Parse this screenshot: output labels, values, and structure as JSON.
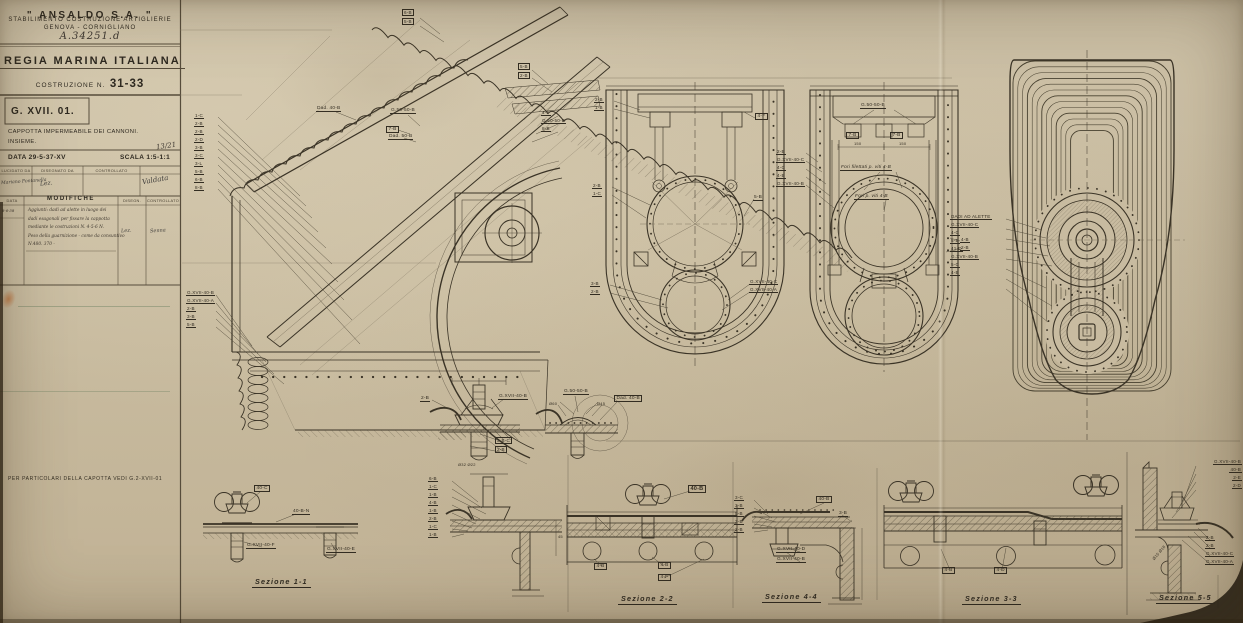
{
  "colors": {
    "paper": "#c8bba0",
    "ink": "#3a3326"
  },
  "title_block": {
    "company": "\" ANSALDO  S.A. \"",
    "establishment": "STABILIMENTO COSTRUZIONE ARTIGLIERIE",
    "location": "GENOVA - CORNIGLIANO",
    "file_number": "A.34251.d",
    "org": "REGIA MARINA ITALIANA",
    "costruzione_label": "COSTRUZIONE N.",
    "costruzione_number": "31-33",
    "drawing_code": "G. XVII. 01.",
    "subject_line1": "CAPPOTTA IMPERMEABILE DEI CANNONI.",
    "subject_line2": "INSIEME.",
    "date": "DATA 29-5-37-XV",
    "scale": "SCALA 1:5-1:1",
    "sheet_mark": "13/21",
    "sig_headers": [
      "LUCIDATO DA",
      "DISEGNATO DA",
      "CONTROLLATO"
    ],
    "signatures": [
      "Mariano Fontanella",
      "Lez.",
      "Valdata"
    ],
    "mod_headers": [
      "DATA",
      "MODIFICHE",
      "DISEGN.",
      "CONTROLLATO"
    ],
    "mod_date": "8-6-38",
    "mod_lines": [
      "Aggiunti: dadi ad alette in luogo dei",
      "dadi esagonali per fissare la cappotta",
      "mediante le costruzioni N. 4-5-6 N.",
      "Peso della guarnizione - come da consuntivo",
      "N.480. 370 -"
    ],
    "mod_sig_disegn": "Lez.",
    "mod_sig_contr": "Senna"
  },
  "notes": {
    "details_note": "PER PARTICOLARI DELLA CAPOTTA VEDI G.2-XVII-01"
  },
  "sections": {
    "s1": "Sezione 1-1",
    "s2": "Sezione 2-2",
    "s3": "Sezione 3-3",
    "s4": "Sezione 4-4",
    "s5": "Sezione 5-5"
  },
  "main_view": {
    "left_stack": [
      "1-C",
      "2-B",
      "2-B",
      "2-D",
      "3-B",
      "3-C",
      "3-L",
      "5-B",
      "6-B",
      "8-B"
    ],
    "left_stack2": [
      "G.XVII-40-B",
      "G.XVII-40-A",
      "2-B",
      "3-B",
      "5-B"
    ],
    "top_stack": [
      "6-B",
      "5-B"
    ],
    "mid_stack": [
      "5-B",
      "2-B"
    ],
    "breech_labels": [
      "Dad. 40-B",
      "G.50-50-B",
      "7-B",
      "Dad. 50-B"
    ],
    "right_stack": [
      "4-F",
      "G.50-50-B",
      "8-B"
    ]
  },
  "plan_view_1": {
    "left_top": [
      "2-B",
      "1-B"
    ],
    "left_mid": [
      "2-B",
      "1-C"
    ],
    "left_bottom": [
      "3-B",
      "2-B"
    ],
    "right_top": "4-F",
    "right_mid": "5-B",
    "right_bottom": [
      "G.XVII-40-C",
      "G.XVII-40-A"
    ]
  },
  "plan_view_2": {
    "top_label": "G.50-50-B",
    "fittings": [
      "7-B",
      "7-B"
    ],
    "dims": [
      "150",
      "150"
    ],
    "note_threads": "Fori filettati p. viti 4-B",
    "note_holes": "Fori p. viti 4-B",
    "left_stack": [
      "2-B",
      "G.XVII-40-C",
      "4-C",
      "4-B",
      "G.XVII-40-B"
    ],
    "right_stack": [
      "4-B",
      "2-B"
    ]
  },
  "top_view": {
    "callouts": [
      "DADI AD ALETTE",
      "G.XVII-40-C",
      "4-C",
      "5-B",
      "41-D",
      "G.XVII-40-B",
      "5-C",
      "4-B"
    ]
  },
  "detail_a": {
    "left": "2-B",
    "right": "G.XVII-40-B",
    "pair": [
      "3-B-C",
      "2-B"
    ],
    "dim": "Ø32  Ø22"
  },
  "detail_b": {
    "top": "G.50-50-B",
    "d1": "Ø60",
    "d2": "Ø45",
    "right": "Dad. 40-B"
  },
  "sez1": {
    "labels": [
      "40-C",
      "40-B-N",
      "G.XVII-40-F",
      "G.XVII-40-E"
    ]
  },
  "detail_c": {
    "stack": [
      "6-B",
      "1-C",
      "1-B",
      "4-B",
      "1-B",
      "2-B",
      "1-C",
      "1-B"
    ],
    "dim": "45"
  },
  "sez2": {
    "labels": [
      "40-B",
      "4-B",
      "4-B",
      "4-F"
    ]
  },
  "sez4": {
    "stack": [
      "3-C",
      "3-B",
      "5-B",
      "3-B",
      "2-B"
    ],
    "labels": [
      "40-B",
      "3-B",
      "G.XVII-40-D",
      "G.XVII-40-B"
    ]
  },
  "sez3": {
    "labels": [
      "4-B",
      "4-D"
    ]
  },
  "sez5": {
    "top_stack": [
      "G.XVII-40-B",
      "40-B",
      "2-E",
      "2-D"
    ],
    "bottom_stack": [
      "2-B",
      "2-B",
      "G.XVII-40-C",
      "G.XVII-40-A"
    ],
    "dim": "Ø15 Ø18"
  }
}
